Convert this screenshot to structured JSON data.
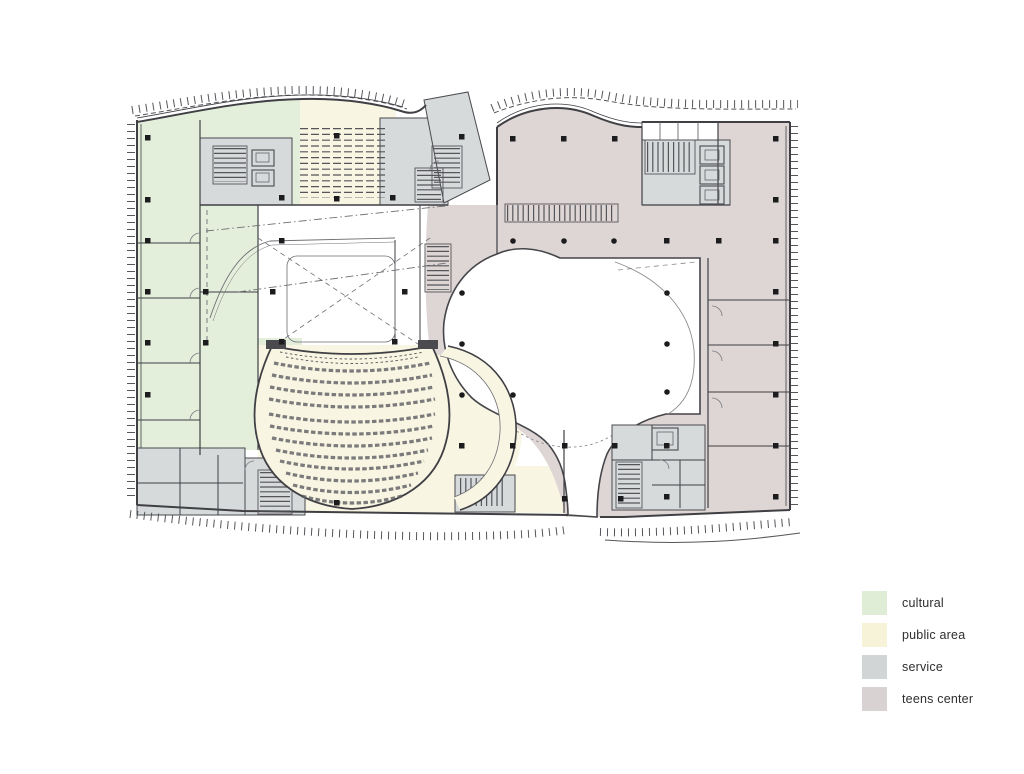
{
  "title": "floor plan",
  "legend": {
    "items": [
      {
        "label": "cultural",
        "color": "#dfecd6"
      },
      {
        "label": "public area",
        "color": "#f6f3d9"
      },
      {
        "label": "service",
        "color": "#d2d5d5"
      },
      {
        "label": "teens center",
        "color": "#d8d2d2"
      }
    ]
  },
  "colors": {
    "cultural": "#e3efdb",
    "public_area": "#f8f5e2",
    "service": "#d7dadb",
    "teens_center": "#ddd6d5",
    "void_white": "#ffffff",
    "wall": "#3f3f44",
    "line": "#6e6e74"
  }
}
